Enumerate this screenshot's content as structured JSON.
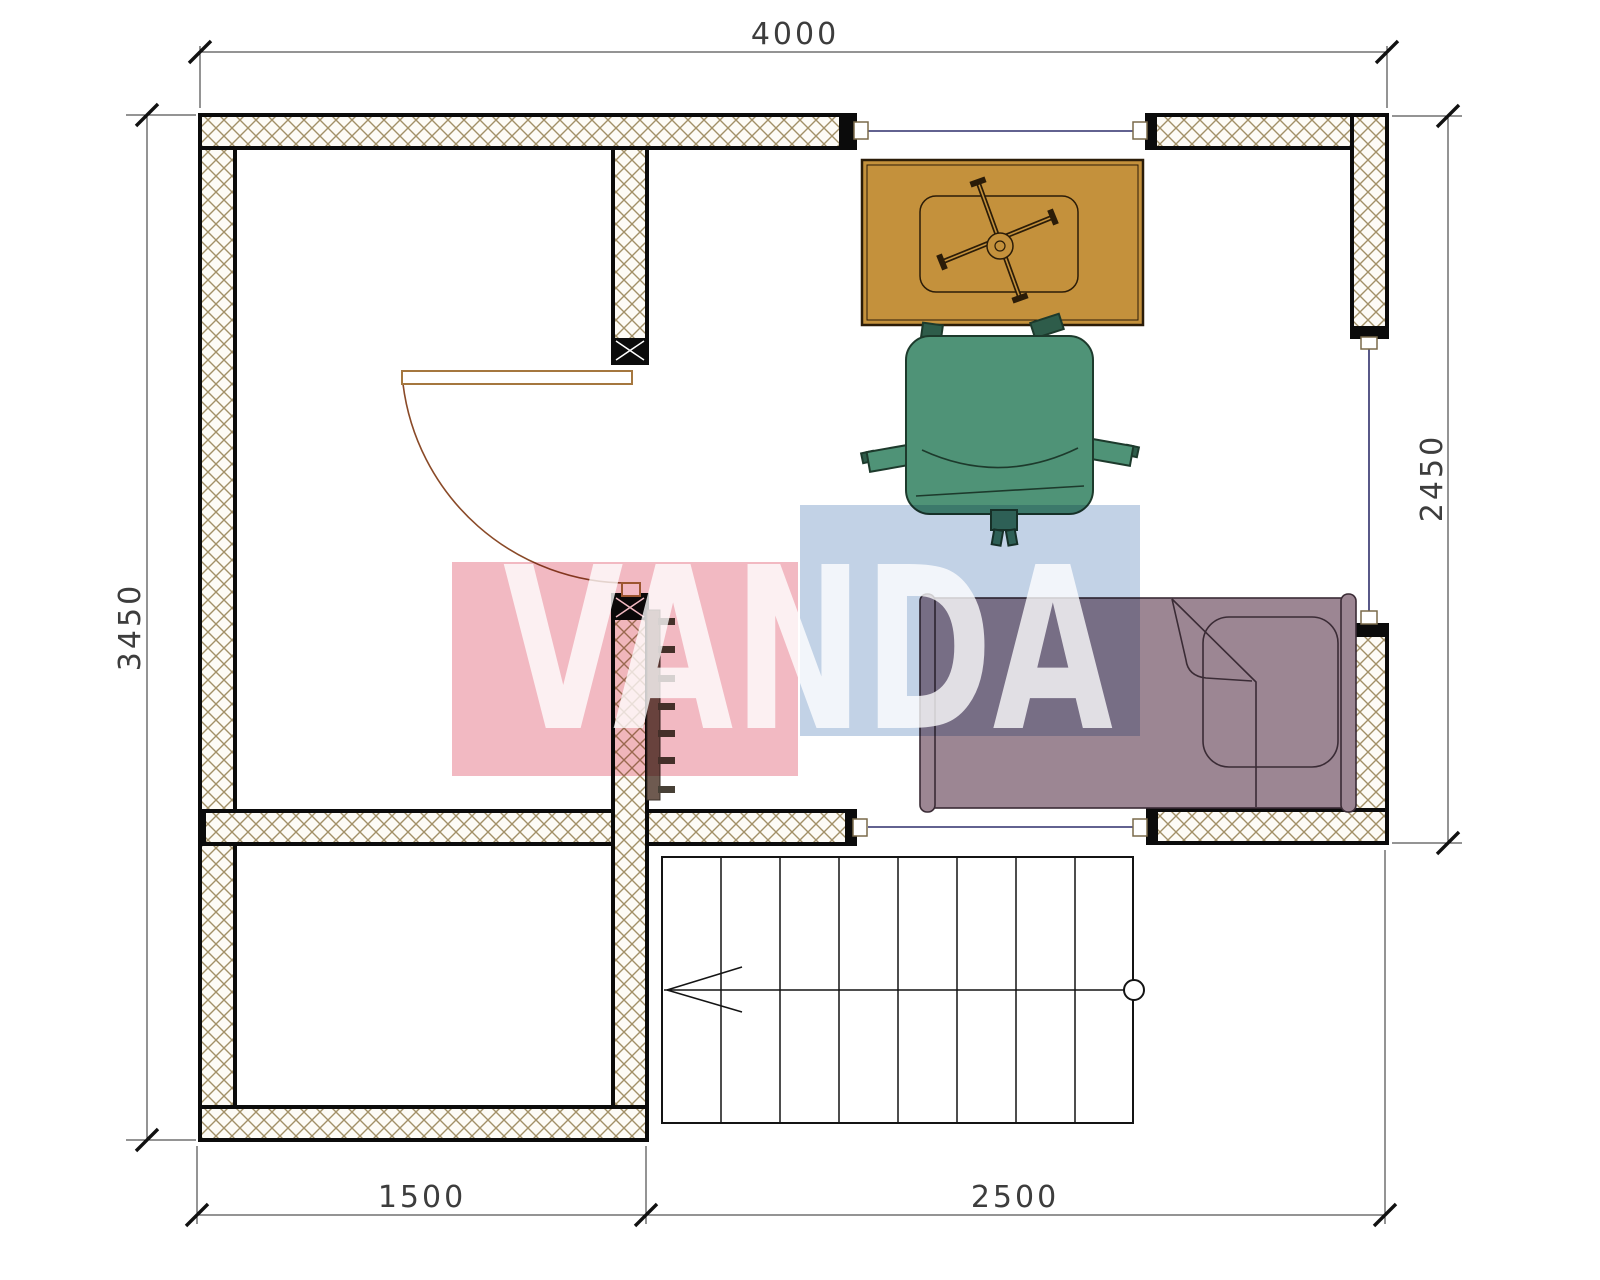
{
  "drawing": {
    "title": "floor-plan"
  },
  "watermark": {
    "text": "VANDA",
    "pink_color": "#f2b9c2",
    "blue_color": "#c2d2e6",
    "text_color": "rgba(255,255,255,0.78)"
  },
  "dimensions": {
    "top": "4000",
    "left": "3450",
    "right": "2450",
    "bottom_left": "1500",
    "bottom_right": "2500"
  },
  "colors": {
    "desk": "#c4913c",
    "desk_outline": "#2b1c08",
    "chair": "#4f9377",
    "chair_dark": "#2e5c4a",
    "chair_outline": "#1d3a2c",
    "bed": "#9c8693",
    "bed_outline": "#3a2b35",
    "wall_hatch": "#a29067",
    "window_glass": "#2f2f6b",
    "radiator_body": "#6e5a50",
    "radiator_fin": "#474036",
    "door": "#a5773f",
    "door_arc": "#8a4a28"
  }
}
